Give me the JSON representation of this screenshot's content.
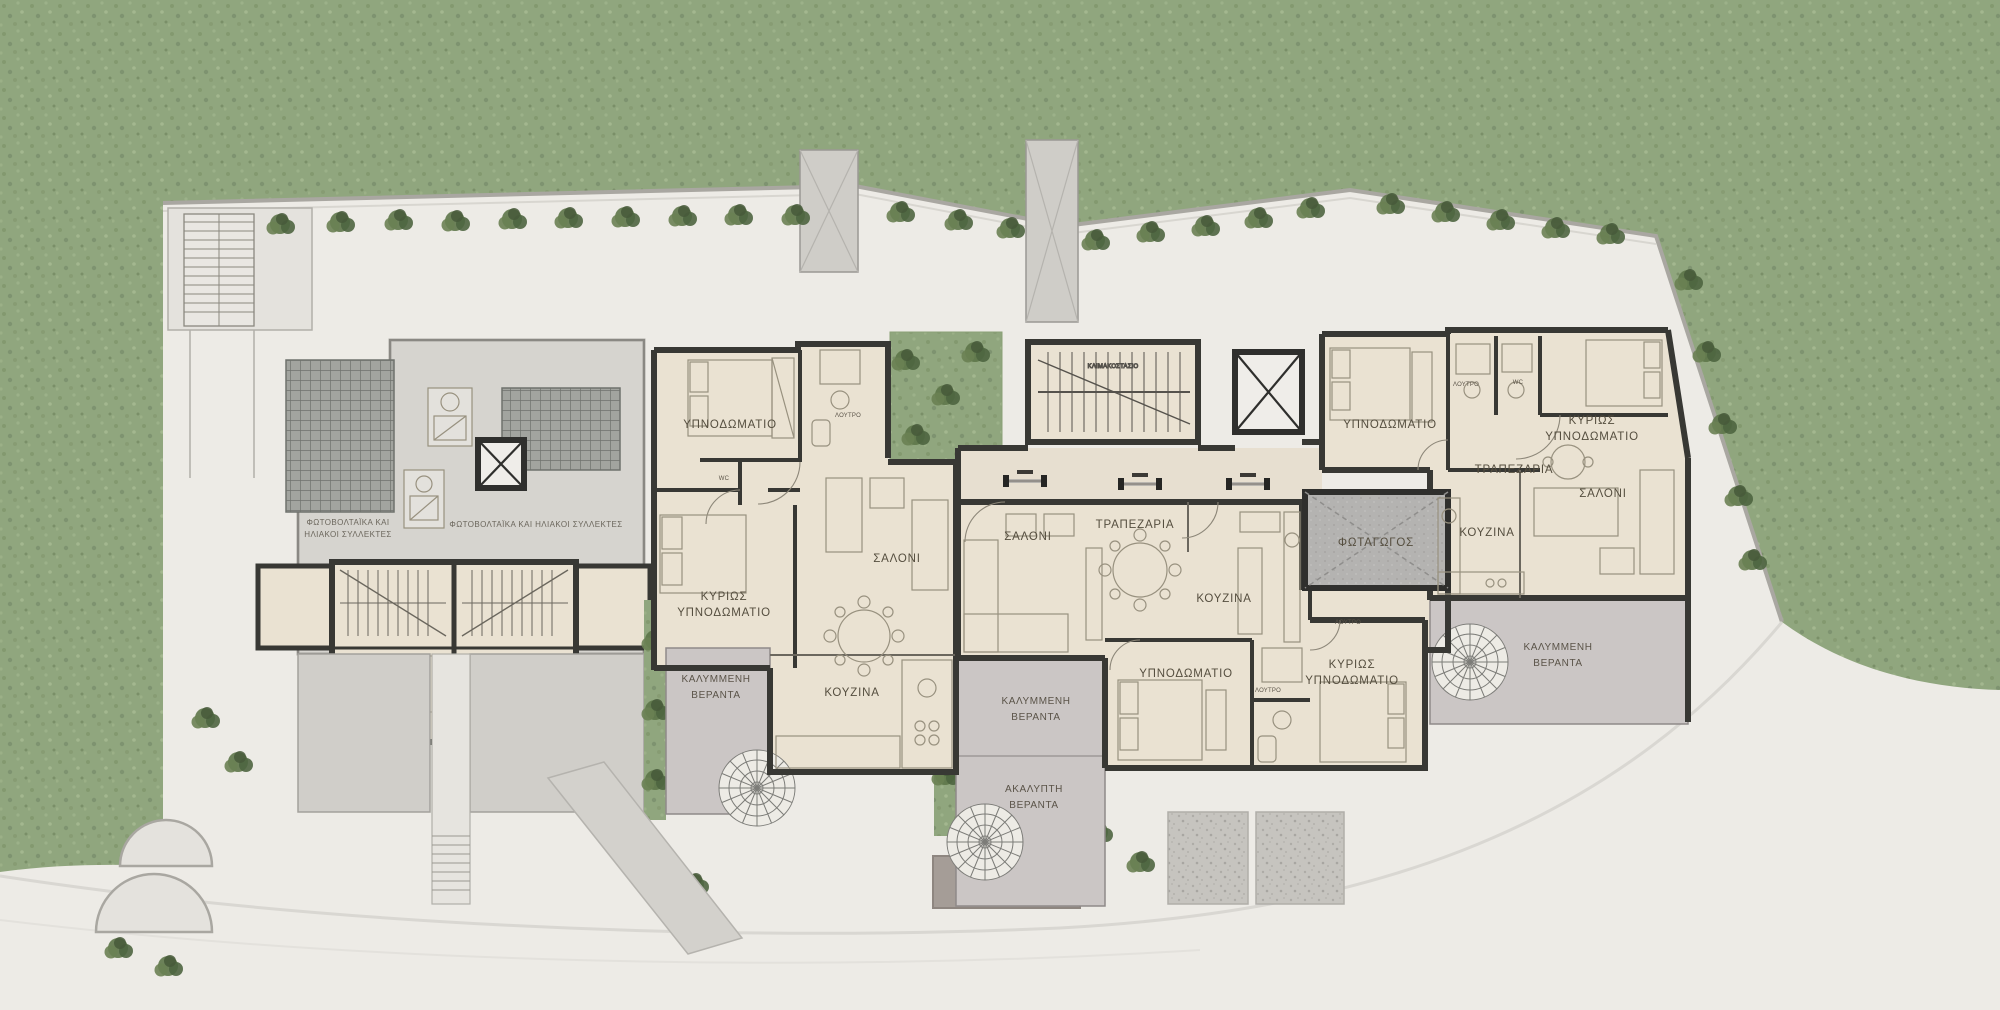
{
  "plan": {
    "type": "architectural-floor-plan",
    "language": "Greek",
    "colors": {
      "grass": "#90a67e",
      "hedge": "#50673f",
      "site": "#edebe6",
      "roof_terrace": "#d6d4cf",
      "solar_panel": "#a2a49f",
      "apartment_floor": "#eae2d2",
      "wall": "#383834",
      "veranda": "#cbc6c5",
      "light_well": "#b4b3b1",
      "driveway": "#a59d97",
      "label_text": "#554e3f"
    },
    "labels": {
      "apt1": {
        "bedroom": "ΥΠΝΟΔΩΜΑΤΙΟ",
        "master1": "ΚΥΡΙΩΣ",
        "master2": "ΥΠΝΟΔΩΜΑΤΙΟ",
        "living": "ΣΑΛΟΝΙ",
        "kitchen": "ΚΟΥΖΙΝΑ",
        "veranda1": "ΚΑΛΥΜΜΕΝΗ",
        "veranda2": "ΒΕΡΑΝΤΑ",
        "bath": "ΛΟΥΤΡΟ",
        "wc": "WC"
      },
      "apt2": {
        "living": "ΣΑΛΟΝΙ",
        "dining": "ΤΡΑΠΕΖΑΡΙΑ",
        "kitchen": "ΚΟΥΖΙΝΑ",
        "bedroom": "ΥΠΝΟΔΩΜΑΤΙΟ",
        "master1": "ΚΥΡΙΩΣ",
        "master2": "ΥΠΝΟΔΩΜΑΤΙΟ",
        "covered1": "ΚΑΛΥΜΜΕΝΗ",
        "covered2": "ΒΕΡΑΝΤΑ",
        "open1": "ΑΚΑΛΥΠΤΗ",
        "open2": "ΒΕΡΑΝΤΑ",
        "bath": "ΛΟΥΤΡΟ",
        "bath2": "ΛΟΥΤΡΟ"
      },
      "apt3": {
        "bedroom": "ΥΠΝΟΔΩΜΑΤΙΟ",
        "master1": "ΚΥΡΙΩΣ",
        "master2": "ΥΠΝΟΔΩΜΑΤΙΟ",
        "dining": "ΤΡΑΠΕΖΑΡΙΑ",
        "living": "ΣΑΛΟΝΙ",
        "kitchen": "ΚΟΥΖΙΝΑ",
        "veranda1": "ΚΑΛΥΜΜΕΝΗ",
        "veranda2": "ΒΕΡΑΝΤΑ",
        "bath1": "ΛΟΥΤΡΟ",
        "bath2": "WC"
      },
      "core": {
        "lightwell": "ΦΩΤΑΓΩΓΟΣ",
        "stair": "ΚΛΙΜΑΚΟΣΤΑΣΙΟ"
      },
      "roof": {
        "left1": "ΦΩΤΟΒΟΛΤΑΪΚΑ ΚΑΙ",
        "left2": "ΗΛΙΑΚΟΙ ΣΥΛΛΕΚΤΕΣ",
        "right": "ΦΩΤΟΒΟΛΤΑΪΚΑ ΚΑΙ ΗΛΙΑΚΟΙ ΣΥΛΛΕΚΤΕΣ"
      }
    }
  }
}
